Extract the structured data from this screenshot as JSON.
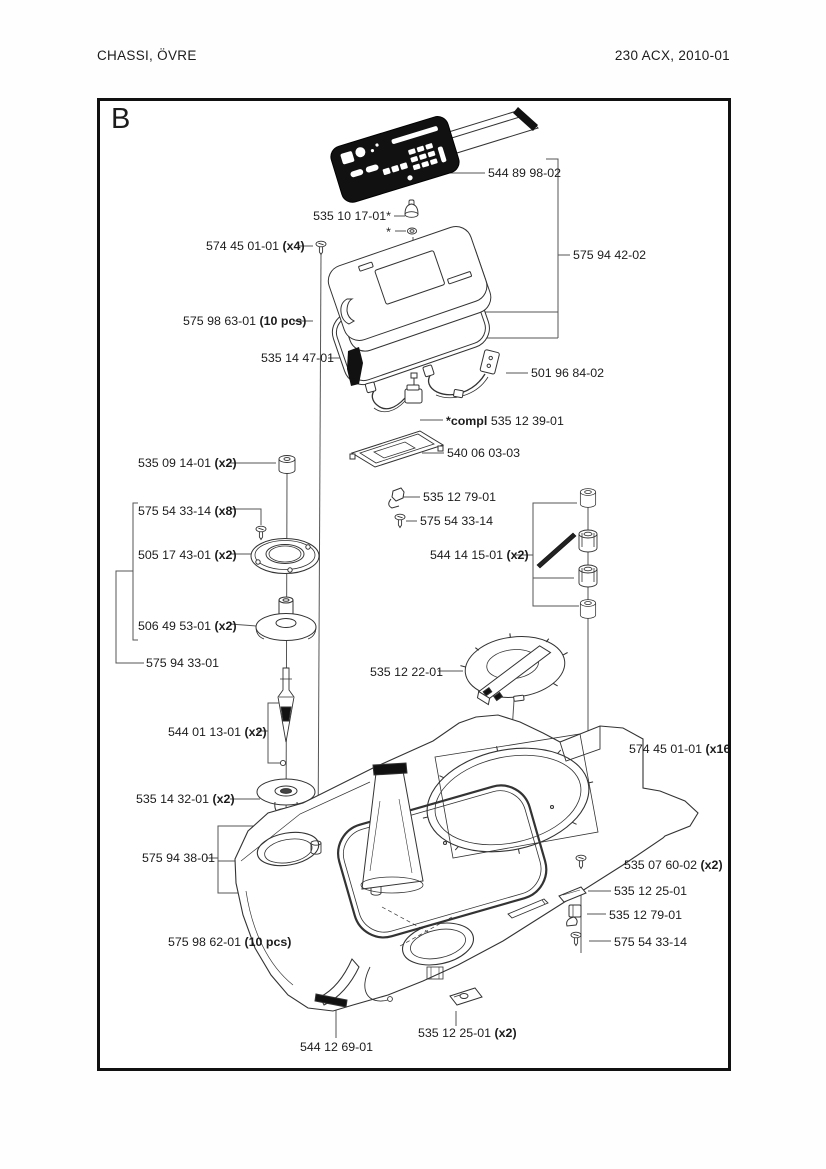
{
  "header": {
    "doc_title": "CHASSI, ÖVRE",
    "model": "230 ACX, 2010-01"
  },
  "figure": {
    "label": "B"
  },
  "colors": {
    "ink": "#1c1c1c",
    "leader": "#555555",
    "part_stroke": "#333333",
    "solid_black": "#111111"
  },
  "labels": [
    {
      "text": "544 89 98-02"
    },
    {
      "text": "535 10 17-01*"
    },
    {
      "text": "*"
    },
    {
      "text": "574 45 01-01",
      "qty": "(x4)"
    },
    {
      "text": "575 94 42-02"
    },
    {
      "text": "575 98 63-01",
      "qty": "(10 pcs)"
    },
    {
      "text": "535 14 47-01"
    },
    {
      "text": "501 96 84-02"
    },
    {
      "prefix": "*compl",
      "text": "535 12 39-01"
    },
    {
      "text": "540 06 03-03"
    },
    {
      "text": "535 09 14-01",
      "qty": "(x2)"
    },
    {
      "text": "535 12 79-01"
    },
    {
      "text": "575 54 33-14"
    },
    {
      "text": "575 54 33-14",
      "qty": "(x8)"
    },
    {
      "text": "505 17 43-01",
      "qty": "(x2)"
    },
    {
      "text": "544 14 15-01",
      "qty": "(x2)"
    },
    {
      "text": "506 49 53-01",
      "qty": "(x2)"
    },
    {
      "text": "575 94 33-01"
    },
    {
      "text": "535 12 22-01"
    },
    {
      "text": "544 01 13-01",
      "qty": "(x2)"
    },
    {
      "text": "574 45 01-01",
      "qty": "(x16)"
    },
    {
      "text": "535 14 32-01",
      "qty": "(x2)"
    },
    {
      "text": "575 94 38-01"
    },
    {
      "text": "535 07 60-02",
      "qty": "(x2)"
    },
    {
      "text": "535 12 25-01"
    },
    {
      "text": "535 12 79-01"
    },
    {
      "text": "575 54 33-14"
    },
    {
      "text": "575 98 62-01",
      "qty": "(10 pcs)"
    },
    {
      "text": "535 12 25-01",
      "qty": "(x2)"
    },
    {
      "text": "544 12 69-01"
    }
  ]
}
